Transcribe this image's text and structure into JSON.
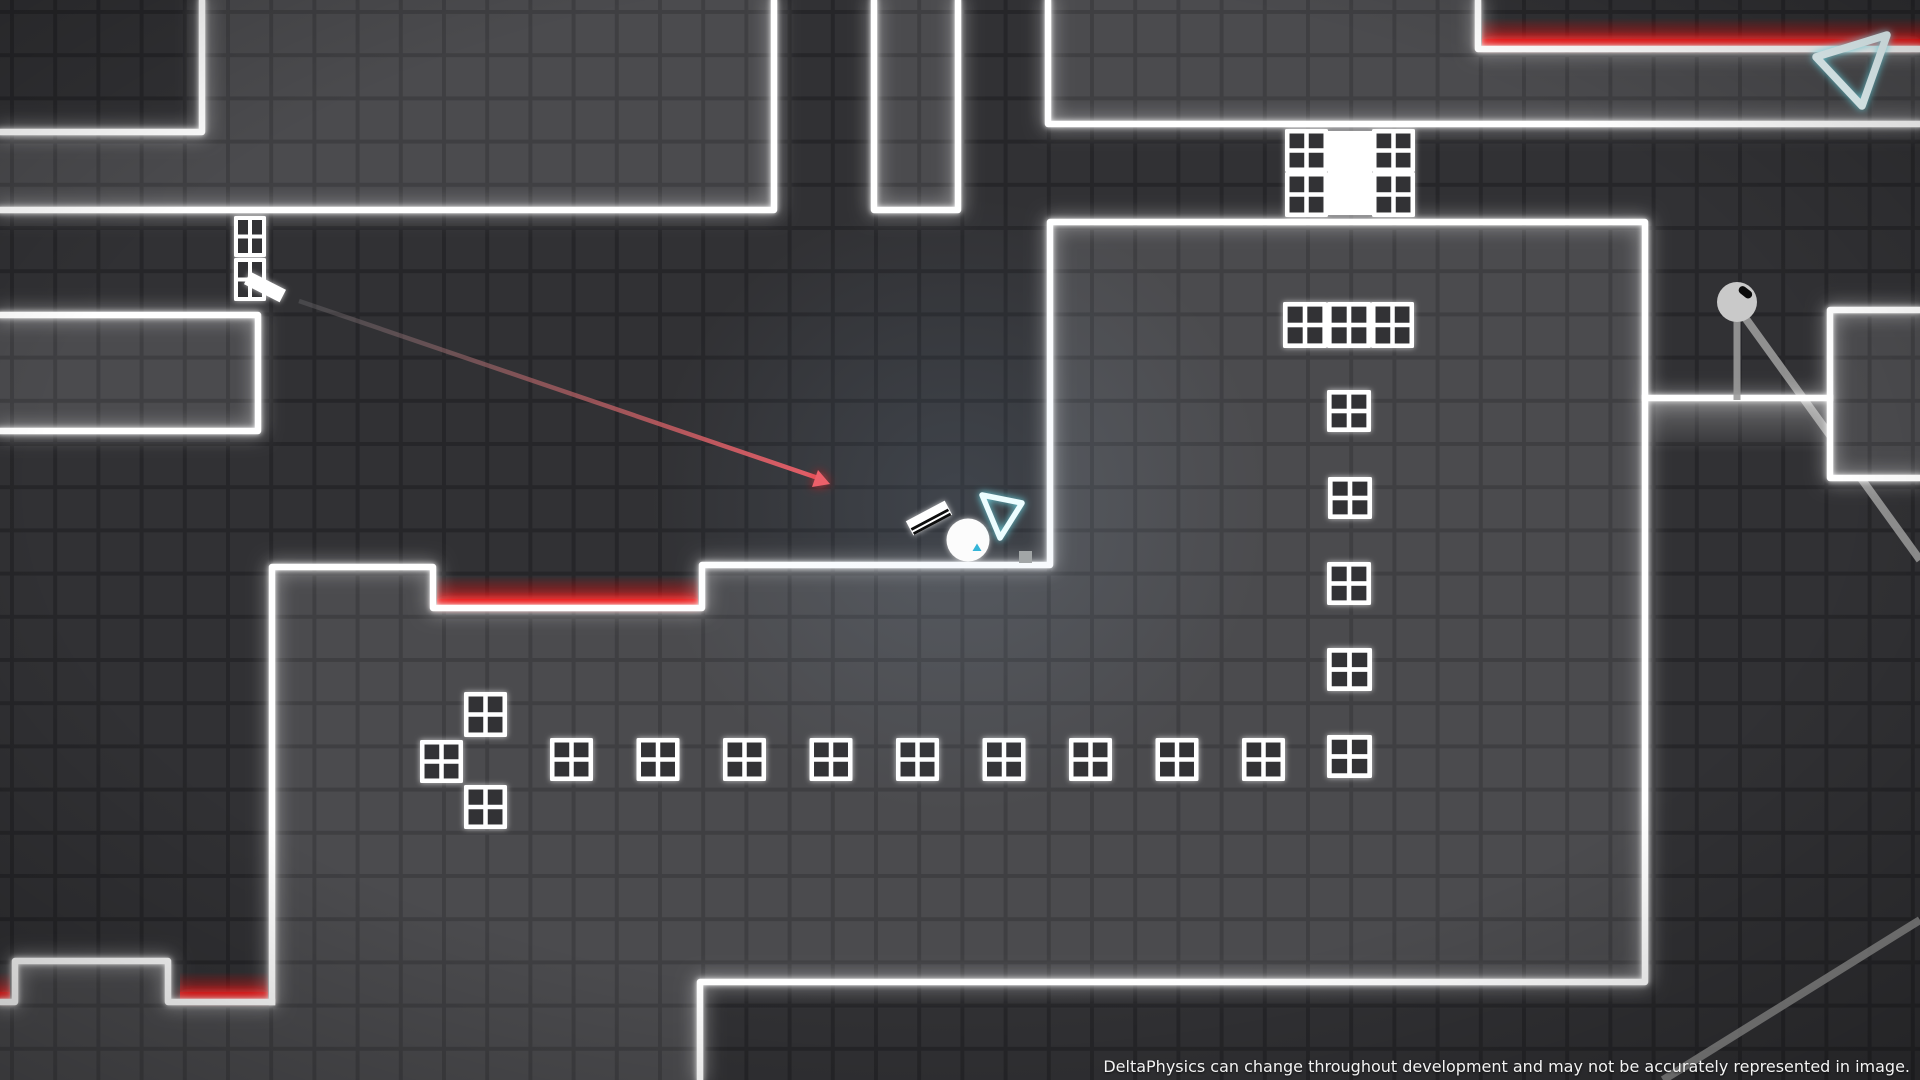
{
  "hud": {
    "disclaimer": "DeltaPhysics can change throughout development and may not be accurately represented in image."
  },
  "colors": {
    "background": "#313134",
    "background_gridline": "#262629",
    "platform": "#4b4b4e",
    "platform_gridline": "#3f3f42",
    "edge_white": "#ffffff",
    "hazard_red": "#e80000",
    "laser_red": "#f25860",
    "portal_cyan": "#74e7f4",
    "portal_stroke": "#ecfdff",
    "marker_cyan": "#35b5d8",
    "player_white": "#fcfcfc",
    "pendulum_gray": "#c9c9c9",
    "rope_gray": "#999999",
    "text": "#f3f3f3"
  },
  "entities": {
    "player": "ball player",
    "paddle": "tilted striped paddle",
    "launcher": "laser launcher paddle",
    "laser": "red aiming laser with arrowhead",
    "portals": "inverted triangle outlines",
    "pendulum": "gray ball on ropes",
    "hazards": "red glowing floor strips",
    "blocks": "white window-pane blocks",
    "door": "white door between window blocks"
  }
}
